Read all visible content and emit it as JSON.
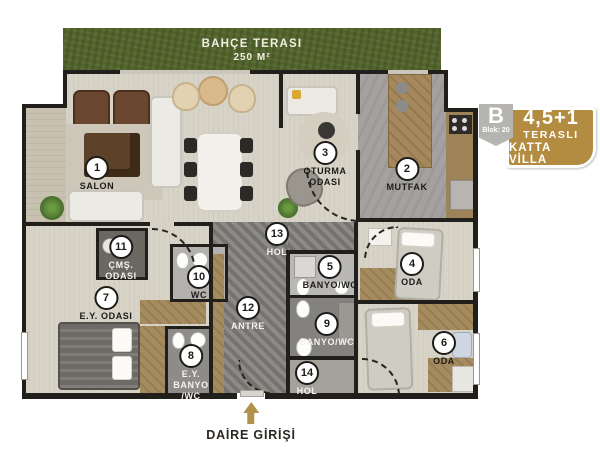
{
  "garden": {
    "title": "BAHÇE TERASI",
    "area": "250 M²"
  },
  "badge": {
    "block_letter": "B",
    "block_number": "Blok: 20",
    "unit_type": "4,5+1",
    "subtitle_line1": "TERASLI",
    "subtitle_line2": "KATTA VİLLA"
  },
  "entrance": {
    "label": "DAİRE GİRİŞİ"
  },
  "rooms": [
    {
      "num": "1",
      "name": "SALON"
    },
    {
      "num": "2",
      "name": "MUTFAK"
    },
    {
      "num": "3",
      "name": "OTURMA\nODASI"
    },
    {
      "num": "4",
      "name": "ODA"
    },
    {
      "num": "5",
      "name": "BANYO/WC"
    },
    {
      "num": "6",
      "name": "ODA"
    },
    {
      "num": "7",
      "name": "E.Y. ODASI"
    },
    {
      "num": "8",
      "name": "E.Y.\nBANYO\n/WC"
    },
    {
      "num": "9",
      "name": "BANYO/WC"
    },
    {
      "num": "10",
      "name": "WC"
    },
    {
      "num": "11",
      "name": "ÇMŞ.\nODASI"
    },
    {
      "num": "12",
      "name": "ANTRE"
    },
    {
      "num": "13",
      "name": "HOL"
    },
    {
      "num": "14",
      "name": "HOL"
    }
  ],
  "colors": {
    "garden_green": "#53652c",
    "wall": "#211f1c",
    "floor_light": "#d7d3c7",
    "floor_dark": "#81807b",
    "badge_gold": "#b38c41",
    "badge_gray": "#b6b4b0",
    "arrow_gold": "#b3914a"
  }
}
